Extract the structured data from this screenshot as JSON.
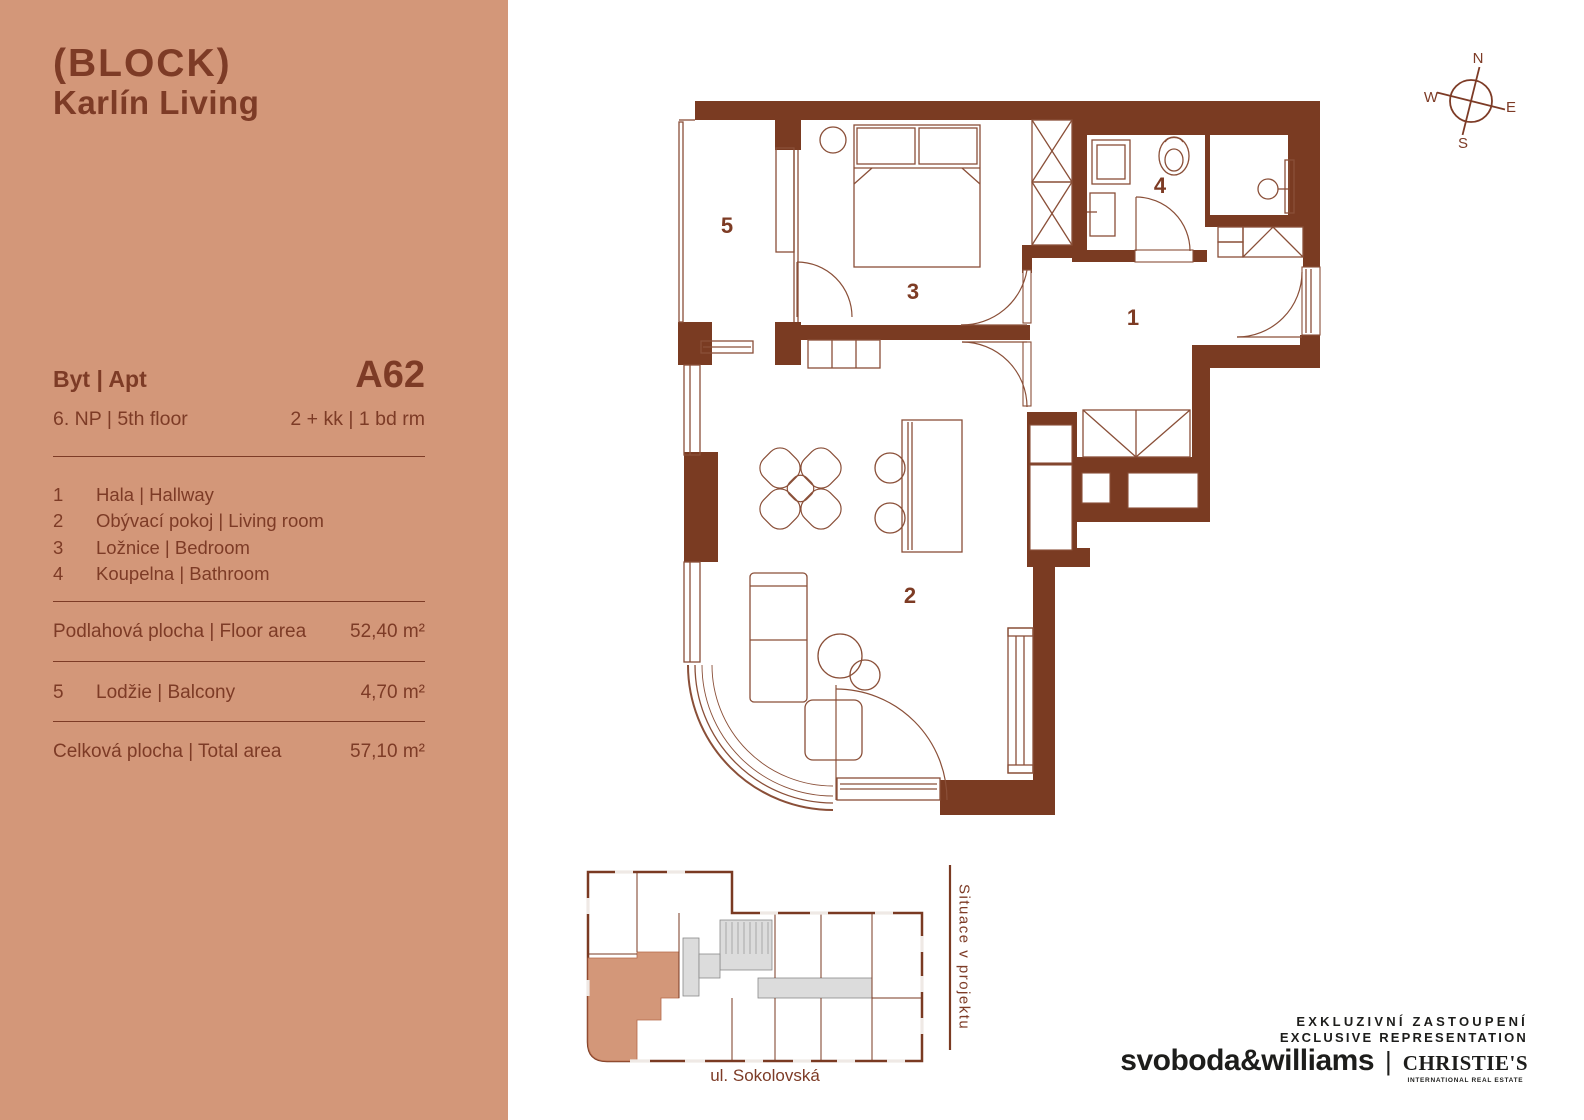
{
  "brand": {
    "logo_line1": "(BLOCK)",
    "logo_line2": "Karlín Living"
  },
  "sidebar": {
    "unit_label": "Byt | Apt",
    "unit_code": "A62",
    "floor": "6. NP | 5th floor",
    "layout": "2 + kk | 1 bd rm",
    "rooms": [
      {
        "num": "1",
        "name": "Hala | Hallway"
      },
      {
        "num": "2",
        "name": "Obývací pokoj | Living room"
      },
      {
        "num": "3",
        "name": "Ložnice | Bedroom"
      },
      {
        "num": "4",
        "name": "Koupelna | Bathroom"
      }
    ],
    "floor_area": {
      "label": "Podlahová plocha | Floor area",
      "value": "52,40 m²"
    },
    "balcony": {
      "num": "5",
      "label": "Lodžie | Balcony",
      "value": "4,70 m²"
    },
    "total": {
      "label": "Celková plocha | Total area",
      "value": "57,10 m²"
    }
  },
  "plan": {
    "labels": {
      "hallway": "1",
      "living": "2",
      "bedroom": "3",
      "bathroom": "4",
      "balcony": "5"
    }
  },
  "compass": {
    "n": "N",
    "e": "E",
    "s": "S",
    "w": "W"
  },
  "siteplan": {
    "street": "ul. Sokolovská",
    "caption": "Situace v projektu"
  },
  "footer": {
    "line1": "EXKLUZIVNÍ ZASTOUPENÍ",
    "line2": "EXCLUSIVE REPRESENTATION",
    "brand1": "svoboda&williams",
    "divider": "|",
    "brand2": "CHRISTIE'S",
    "brand2_sub": "INTERNATIONAL REAL ESTATE"
  },
  "colors": {
    "sidebar_bg": "#d39779",
    "accent_text": "#7d3b26",
    "wall": "#7a3b22",
    "thin_line": "#8a4f38",
    "dark_text": "#1d1d1b",
    "site_gray": "#dcdcdc",
    "site_highlight": "#d39779"
  }
}
